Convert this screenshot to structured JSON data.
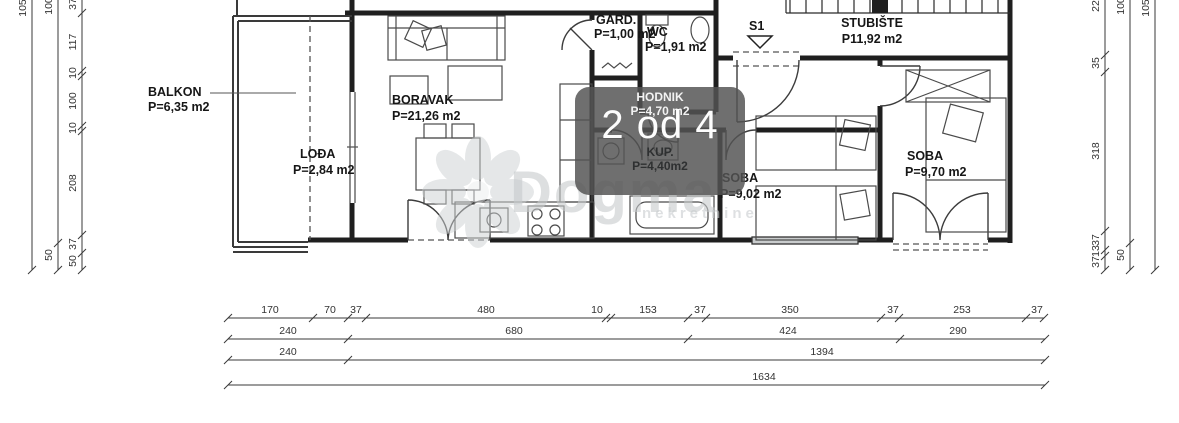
{
  "plan": {
    "rooms": {
      "balkon": {
        "name": "BALKON",
        "area": "P=6,35 m2"
      },
      "lodja": {
        "name": "LOĐA",
        "area": "P=2,84 m2"
      },
      "boravak": {
        "name": "BORAVAK",
        "area": "P=21,26 m2"
      },
      "gard": {
        "name": "GARD.",
        "area": "P=1,00 m2"
      },
      "wc": {
        "name": "WC",
        "area": "P=1,91 m2"
      },
      "hodnik": {
        "name": "HODNIK",
        "area": "P=4,70 m2"
      },
      "kup": {
        "name": "KUP.",
        "area": "P=4,40m2"
      },
      "soba1": {
        "name": "SOBA",
        "area": "P=9,02 m2"
      },
      "soba2": {
        "name": "SOBA",
        "area": "P=9,70 m2"
      },
      "stubiste": {
        "name": "STUBIŠTE",
        "area": "P11,92 m2"
      }
    },
    "entrance_label": "S1"
  },
  "overlay": {
    "photo_counter": "2 od 4",
    "badge_color": "#545454"
  },
  "watermark": {
    "brand": "Dogma",
    "tagline": "nekretnine"
  },
  "dims": {
    "bottom": {
      "row1": [
        "170",
        "70",
        "37",
        "480",
        "10",
        "153",
        "37",
        "350",
        "37",
        "253",
        "37"
      ],
      "row2": [
        "240",
        "680",
        "424",
        "290"
      ],
      "row3": [
        "240",
        "1394"
      ],
      "row4": [
        "1634"
      ]
    },
    "left": {
      "outer": [
        "105"
      ],
      "middle": [
        "100",
        "50"
      ],
      "inner": [
        "37",
        "117",
        "10",
        "100",
        "10",
        "208",
        "37",
        "50"
      ]
    },
    "right": {
      "inner": [
        "22",
        "35",
        "318",
        "37",
        "13",
        "37"
      ],
      "middle": [
        "100",
        "50"
      ],
      "outer": [
        "105"
      ]
    }
  }
}
